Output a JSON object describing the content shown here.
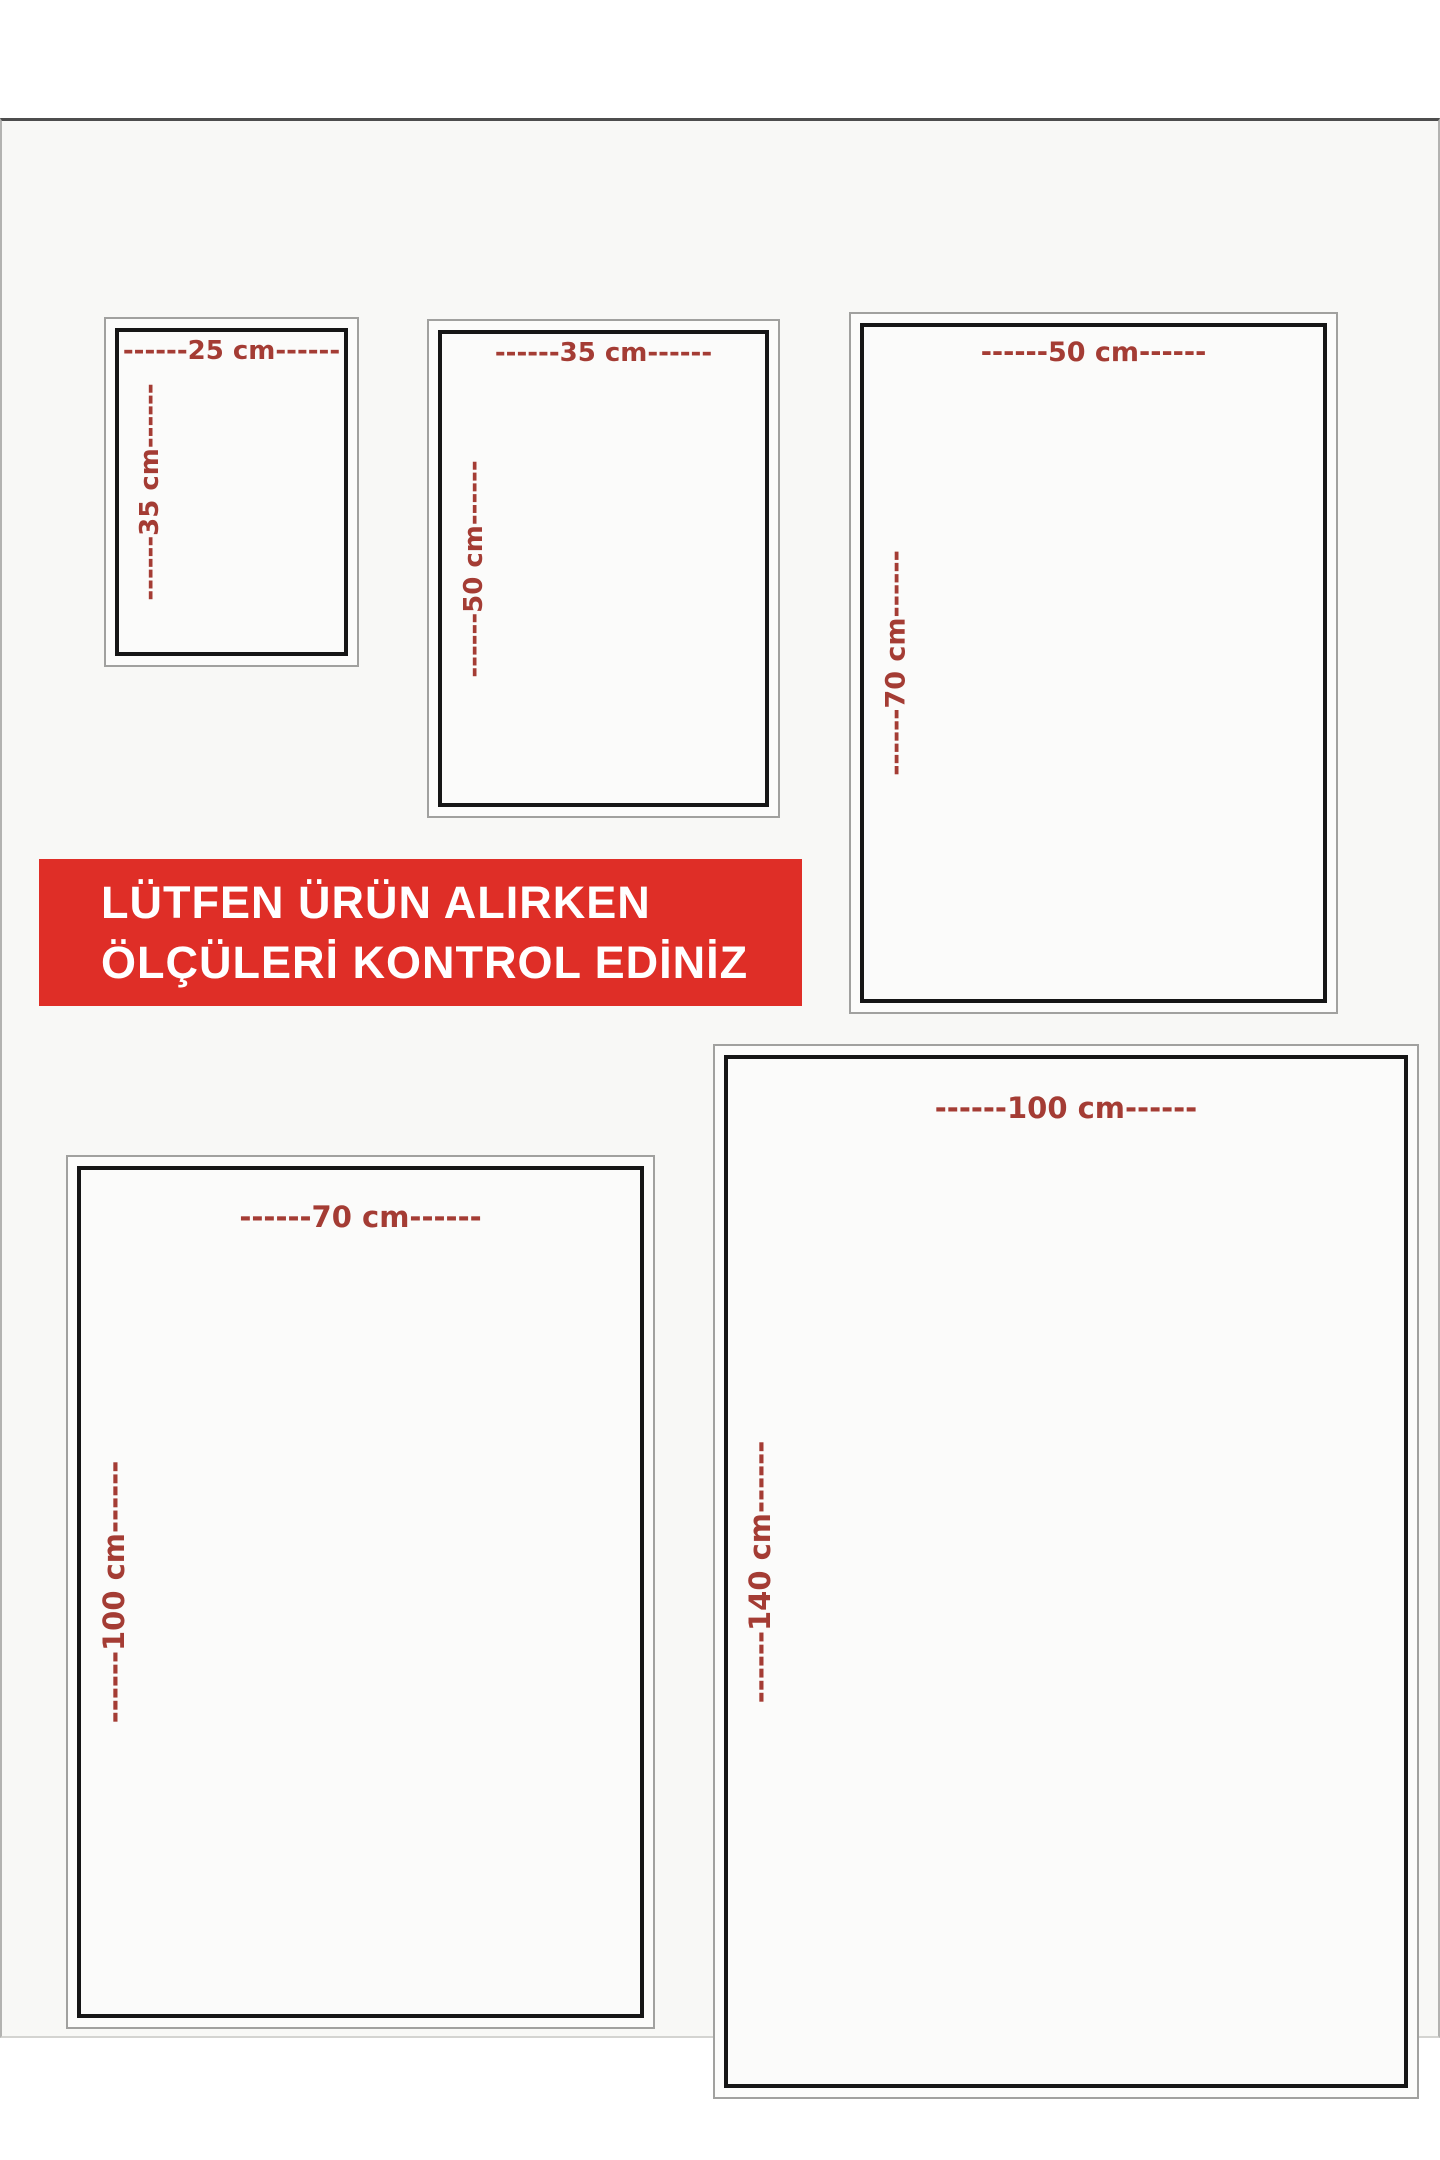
{
  "banner": {
    "line1": "LÜTFEN ÜRÜN ALIRKEN",
    "line2": "ÖLÇÜLERİ KONTROL EDİNİZ"
  },
  "sizes": [
    {
      "name": "25x35",
      "width_cm": 25,
      "height_cm": 35,
      "width_label": "------25 cm------",
      "height_label": "------35 cm------"
    },
    {
      "name": "35x50",
      "width_cm": 35,
      "height_cm": 50,
      "width_label": "------35 cm------",
      "height_label": "------50 cm------"
    },
    {
      "name": "50x70",
      "width_cm": 50,
      "height_cm": 70,
      "width_label": "------50 cm------",
      "height_label": "------70 cm------"
    },
    {
      "name": "70x100",
      "width_cm": 70,
      "height_cm": 100,
      "width_label": "------70 cm------",
      "height_label": "------100 cm------"
    },
    {
      "name": "100x140",
      "width_cm": 100,
      "height_cm": 140,
      "width_label": "------100 cm------",
      "height_label": "------140 cm------"
    }
  ],
  "colors": {
    "banner_bg": "#df2e27",
    "banner_text": "#ffffff",
    "dimension_text": "#a43c34",
    "inner_border": "#161616",
    "outer_border": "#a1a19f"
  }
}
